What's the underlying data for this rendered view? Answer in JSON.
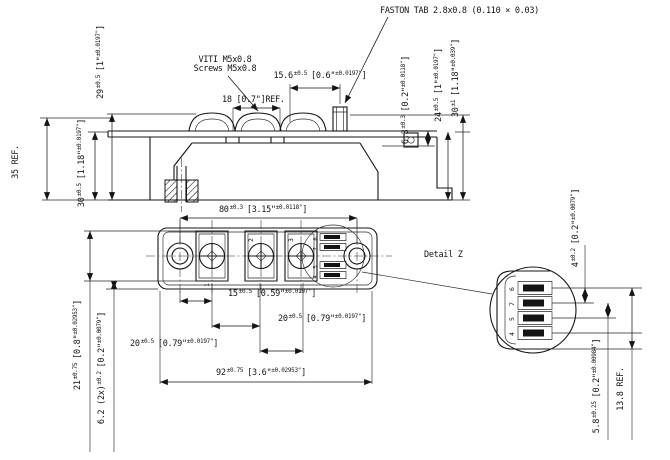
{
  "notes": {
    "faston": "FASTON TAB 2.8x0.8 (0.110 × 0.03)",
    "screws_it": "VITI M5x0.8",
    "screws_en": "Screws M5x0.8",
    "detail": "Detail Z"
  },
  "dims": {
    "d29": {
      "m": "29",
      "t": "±0.5",
      "b": "[1\"",
      "bt": "±0.0197\"",
      "e": "]"
    },
    "d35": {
      "label": "35 REF."
    },
    "d30l": {
      "m": "30",
      "t": "±0.5",
      "b": "[1.18\"",
      "bt": "±0.0197\"",
      "e": "]"
    },
    "d18": {
      "label": "18 [0.7\"]REF."
    },
    "d15_6": {
      "m": "15.6",
      "t": "±0.5",
      "b": "[0.6\"",
      "bt": "±0.0197\"",
      "e": "]"
    },
    "d6_3": {
      "m": "6.3",
      "t": "±0.3",
      "b": "[0.2\"",
      "bt": "±0.0118\"",
      "e": "]"
    },
    "d24": {
      "m": "24",
      "t": "±0.5",
      "b": "[1\"",
      "bt": "±0.0197\"",
      "e": "]"
    },
    "d30r": {
      "m": "30",
      "t": "±1",
      "b": "[1.18\"",
      "bt": "±0.039\"",
      "e": "]"
    },
    "d80": {
      "m": "80",
      "t": "±0.3",
      "b": "[3.15\"",
      "bt": "±0.0118\"",
      "e": "]"
    },
    "d15": {
      "m": "15",
      "t": "±0.5",
      "b": "[0.59\"",
      "bt": "±0.0197\"",
      "e": "]"
    },
    "d20r": {
      "m": "20",
      "t": "±0.5",
      "b": "[0.79\"",
      "bt": "±0.0197\"",
      "e": "]"
    },
    "d20l": {
      "m": "20",
      "t": "±0.5",
      "b": "[0.79\"",
      "bt": "±0.0197\"",
      "e": "]"
    },
    "d92": {
      "m": "92",
      "t": "±0.75",
      "b": "[3.6\"",
      "bt": "±0.02953\"",
      "e": "]"
    },
    "d21": {
      "m": "21",
      "t": "±0.75",
      "b": "[0.8\"",
      "bt": "±0.02953\"",
      "e": "]"
    },
    "d6_2": {
      "m": "6.2 (2x)",
      "t": "±0.2",
      "b": "[0.2\"",
      "bt": "±0.0079\"",
      "e": "]"
    },
    "d4": {
      "m": "4",
      "t": "±0.2",
      "b": "[0.2\"",
      "bt": "±0.0079\"",
      "e": "]"
    },
    "d5_8": {
      "m": "5.8",
      "t": "±0.25",
      "b": "[0.2\"",
      "bt": "±0.00984\"",
      "e": "]"
    },
    "d13_8": {
      "label": "13.8 REF."
    }
  },
  "terminals": {
    "main": [
      "1",
      "2",
      "3"
    ],
    "aux": [
      "6",
      "7",
      "5",
      "4"
    ]
  },
  "colors": {
    "ink": "#141414",
    "background": "#ffffff"
  }
}
